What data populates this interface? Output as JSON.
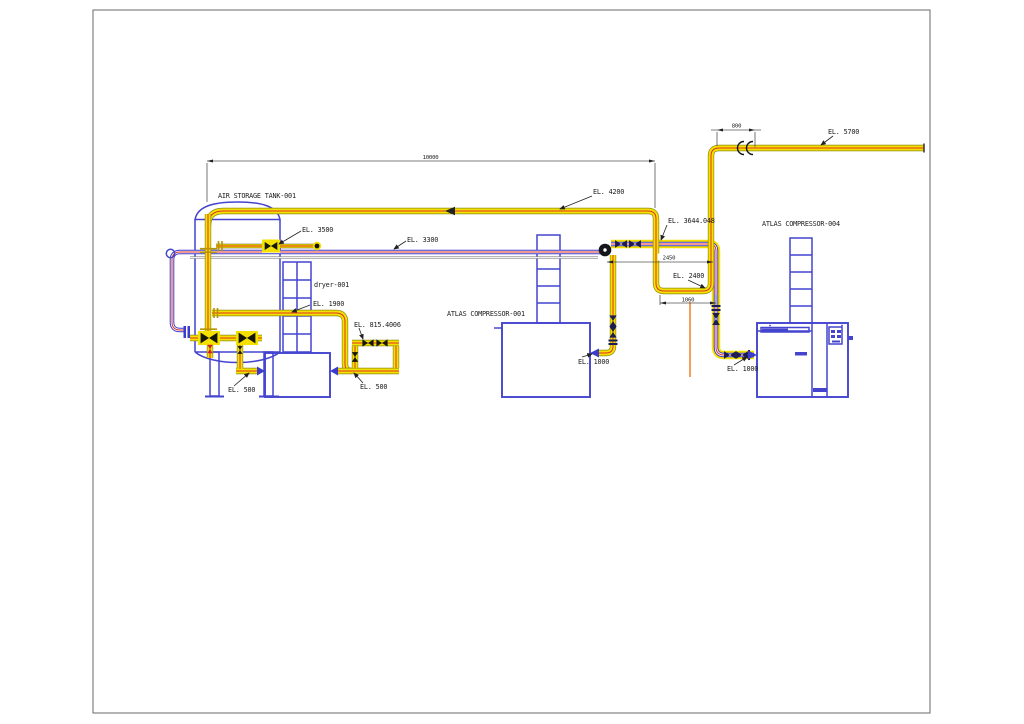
{
  "labels": {
    "tank": "AIR STORAGE TANK-001",
    "dryer": "dryer-001",
    "compressor1": "ATLAS COMPRESSOR-001",
    "compressor4": "ATLAS COMPRESSOR-004"
  },
  "elevations": {
    "header_5700": "EL. 5700",
    "header_4200": "EL. 4200",
    "line_3644": "EL. 3644.048",
    "tank_nozzle_3500": "EL. 3500",
    "line_3300": "EL. 3300",
    "loop_2400": "EL. 2400",
    "dryer_inlet_1900": "EL. 1900",
    "dryer_bypass_815": "EL. 815.4006",
    "tank_outlet_500": "EL. 500",
    "dryer_outlet_500": "EL. 500",
    "compressor1_discharge_1000": "EL. 1000",
    "compressor4_discharge_1000": "EL. 1000"
  },
  "dimensions": {
    "header_run": "10000",
    "riser_offset": "800",
    "junction_span": "2450",
    "loop_width": "1060"
  },
  "symbols": {
    "valve": "bowtie-valve",
    "flange": "triangle-flange",
    "junction": "junction-node",
    "coupling": "pipe-coupling"
  },
  "colors": {
    "pipe_highlight_yellow": "#f5e100",
    "pipe_outline_olive": "#8a8a10",
    "centerline_red": "#e03228",
    "pipe_blue": "#3c3ccc",
    "equipment_blue": "#4444cf",
    "valve_navy": "#1c1c50",
    "valve_red": "#cc2222",
    "drain_orange": "#f07818",
    "dim_line": "#555555",
    "text_dark": "#1c1c1c",
    "sheet_border": "#6a6a6a"
  }
}
